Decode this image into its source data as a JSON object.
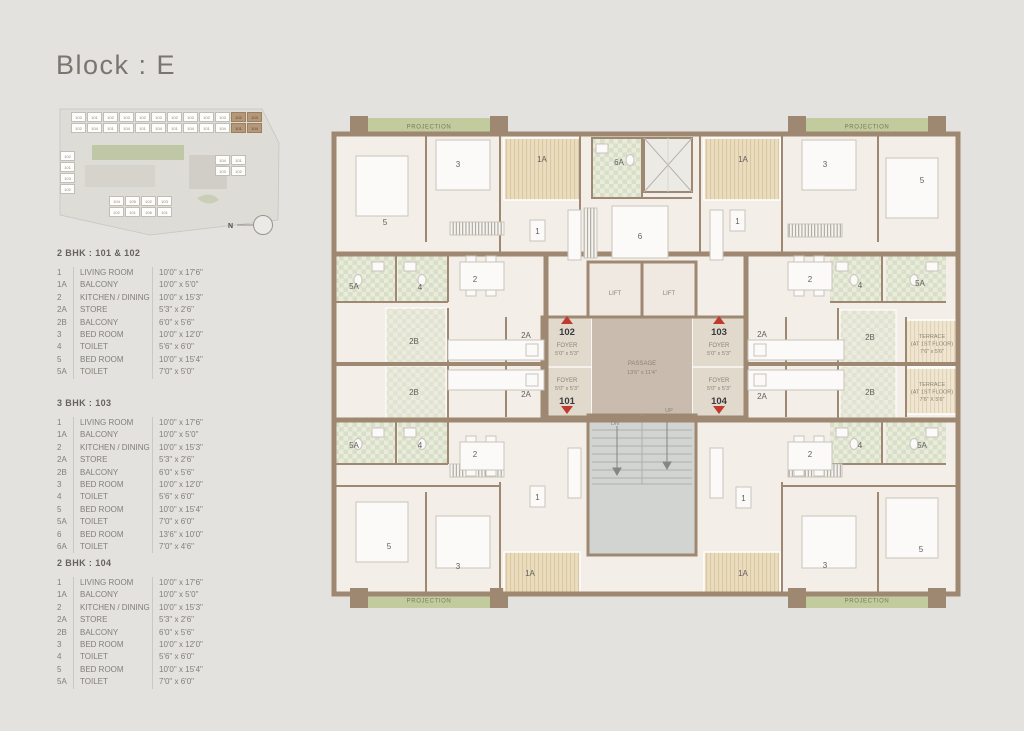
{
  "title": "Block : E",
  "colors": {
    "wall": "#9f8872",
    "projection_green": "#c2cb9e",
    "unit_red": "#bf3b30",
    "background": "#e4e2de"
  },
  "key_plan": {
    "north_label": "N",
    "strip_row1": [
      "103",
      "101",
      "102",
      "103",
      "102",
      "103",
      "102",
      "103",
      "102",
      "103",
      "102",
      "103"
    ],
    "strip_row2": [
      "102",
      "104",
      "101",
      "104",
      "101",
      "104",
      "101",
      "104",
      "101",
      "104",
      "101",
      "104"
    ],
    "cluster_right": [
      "104",
      "101",
      "103",
      "102"
    ],
    "cluster_left": [
      "102",
      "101",
      "103",
      "102"
    ],
    "cluster_bottom": [
      "104",
      "105",
      "102",
      "103",
      "102",
      "101",
      "106",
      "101"
    ]
  },
  "legends": [
    {
      "title": "2 BHK : 101 & 102",
      "rows": [
        {
          "id": "1",
          "name": "LIVING ROOM",
          "size": "10'0\" x 17'6\""
        },
        {
          "id": "1A",
          "name": "BALCONY",
          "size": "10'0\" x 5'0\""
        },
        {
          "id": "2",
          "name": "KITCHEN / DINING",
          "size": "10'0\" x 15'3\""
        },
        {
          "id": "2A",
          "name": "STORE",
          "size": "5'3\" x 2'6\""
        },
        {
          "id": "2B",
          "name": "BALCONY",
          "size": "6'0\" x 5'6\""
        },
        {
          "id": "3",
          "name": "BED ROOM",
          "size": "10'0\" x 12'0\""
        },
        {
          "id": "4",
          "name": "TOILET",
          "size": "5'6\" x 6'0\""
        },
        {
          "id": "5",
          "name": "BED ROOM",
          "size": "10'0\" x 15'4\""
        },
        {
          "id": "5A",
          "name": "TOILET",
          "size": "7'0\" x 5'0\""
        }
      ]
    },
    {
      "title": "3 BHK : 103",
      "rows": [
        {
          "id": "1",
          "name": "LIVING ROOM",
          "size": "10'0\" x 17'6\""
        },
        {
          "id": "1A",
          "name": "BALCONY",
          "size": "10'0\" x 5'0\""
        },
        {
          "id": "2",
          "name": "KITCHEN / DINING",
          "size": "10'0\" x 15'3\""
        },
        {
          "id": "2A",
          "name": "STORE",
          "size": "5'3\" x 2'6\""
        },
        {
          "id": "2B",
          "name": "BALCONY",
          "size": "6'0\" x 5'6\""
        },
        {
          "id": "3",
          "name": "BED ROOM",
          "size": "10'0\" x 12'0\""
        },
        {
          "id": "4",
          "name": "TOILET",
          "size": "5'6\" x 6'0\""
        },
        {
          "id": "5",
          "name": "BED ROOM",
          "size": "10'0\" x 15'4\""
        },
        {
          "id": "5A",
          "name": "TOILET",
          "size": "7'0\" x 6'0\""
        },
        {
          "id": "6",
          "name": "BED ROOM",
          "size": "13'6\" x 10'0\""
        },
        {
          "id": "6A",
          "name": "TOILET",
          "size": "7'0\" x 4'6\""
        }
      ]
    },
    {
      "title": "2 BHK : 104",
      "rows": [
        {
          "id": "1",
          "name": "LIVING ROOM",
          "size": "10'0\" x 17'6\""
        },
        {
          "id": "1A",
          "name": "BALCONY",
          "size": "10'0\" x 5'0\""
        },
        {
          "id": "2",
          "name": "KITCHEN / DINING",
          "size": "10'0\" x 15'3\""
        },
        {
          "id": "2A",
          "name": "STORE",
          "size": "5'3\" x 2'6\""
        },
        {
          "id": "2B",
          "name": "BALCONY",
          "size": "6'0\" x 5'6\""
        },
        {
          "id": "3",
          "name": "BED ROOM",
          "size": "10'0\" x 12'0\""
        },
        {
          "id": "4",
          "name": "TOILET",
          "size": "5'6\" x 6'0\""
        },
        {
          "id": "5",
          "name": "BED ROOM",
          "size": "10'0\" x 15'4\""
        },
        {
          "id": "5A",
          "name": "TOILET",
          "size": "7'0\" x 6'0\""
        }
      ]
    }
  ],
  "plan": {
    "projection": "PROJECTION",
    "lift": "LIFT",
    "dn": "DN",
    "up": "UP",
    "passage": {
      "name": "PASSAGE",
      "size": "13'6\" x 11'4\""
    },
    "foyer": {
      "name": "FOYER",
      "size": "5'0\" x 5'3\""
    },
    "units": {
      "u101": "101",
      "u102": "102",
      "u103": "103",
      "u104": "104"
    },
    "terrace_name": "TERRACE",
    "terrace_floor": "(AT 1ST FLOOR)",
    "terraces": [
      {
        "size": "7'6\" x 5'6\""
      },
      {
        "size": "7'6\" X 5'6\""
      }
    ],
    "rooms": {
      "r1": "1",
      "r1a": "1A",
      "r2": "2",
      "r2a": "2A",
      "r2b": "2B",
      "r3": "3",
      "r4": "4",
      "r5": "5",
      "r5a": "5A",
      "r6": "6",
      "r6a": "6A"
    }
  }
}
